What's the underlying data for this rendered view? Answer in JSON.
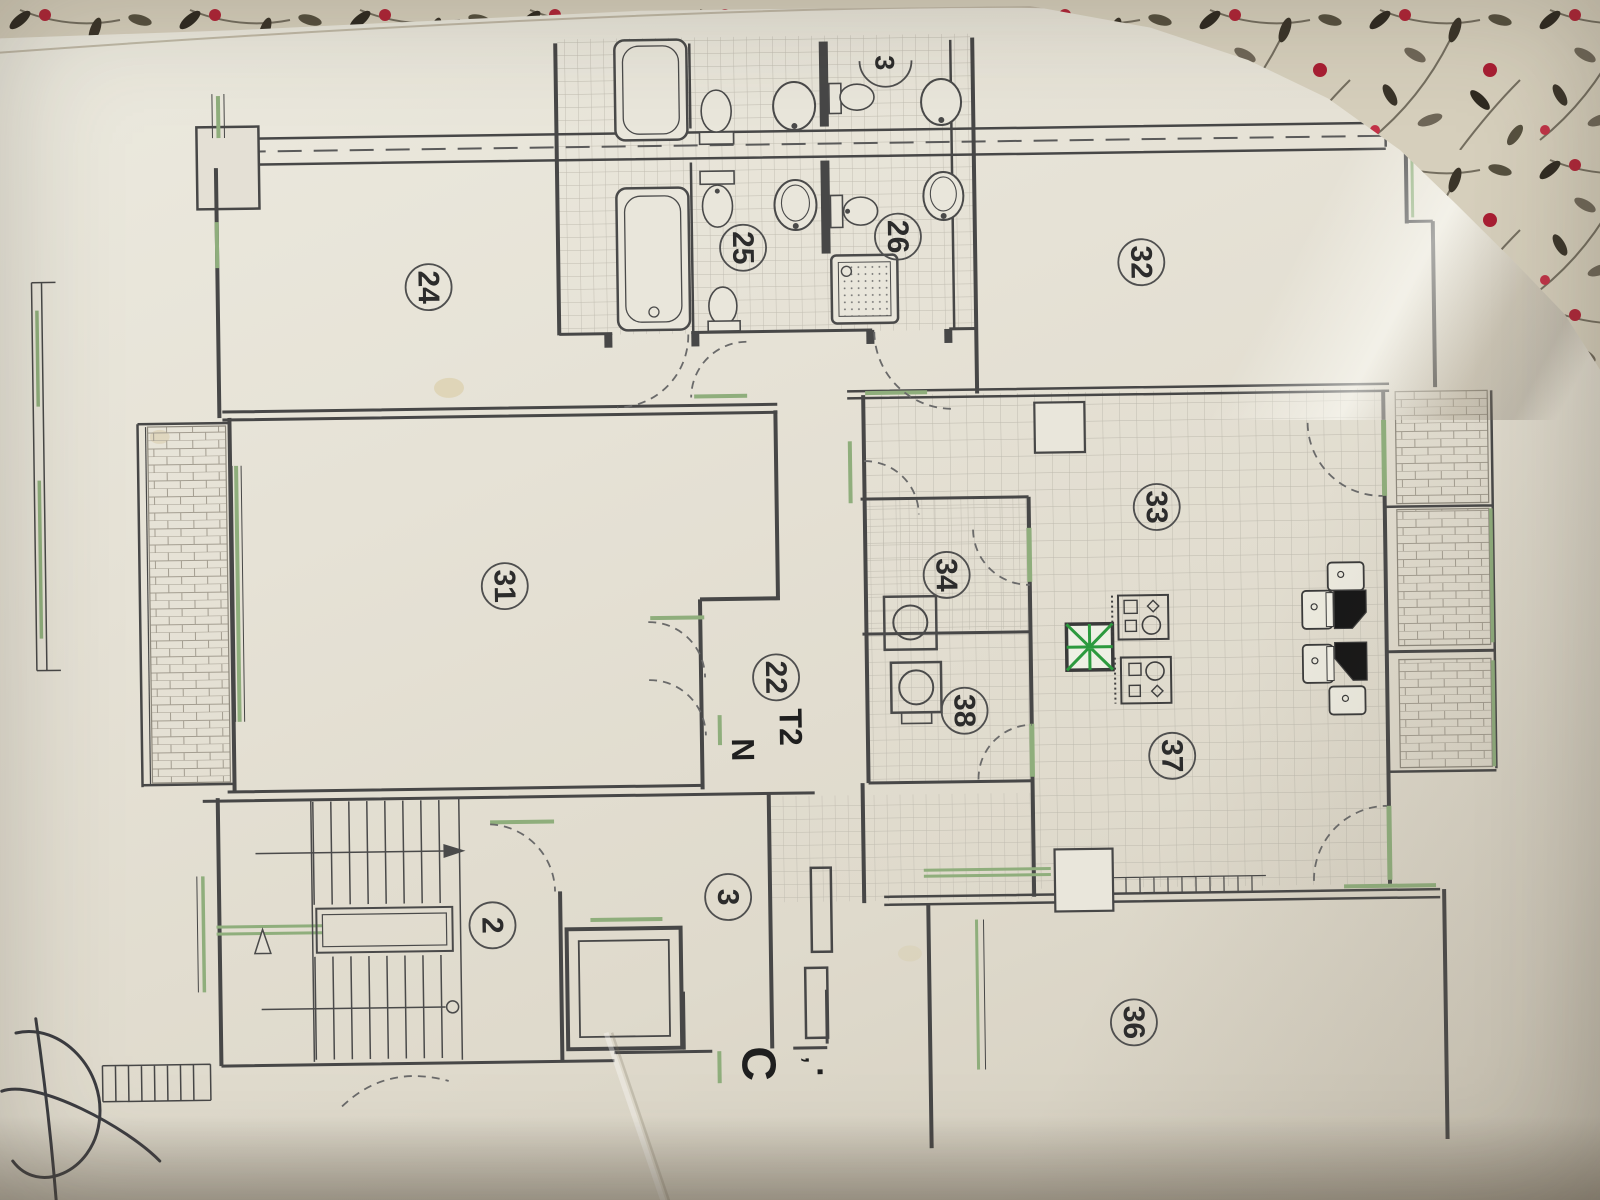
{
  "plan": {
    "partial_room_number": "3",
    "rooms": [
      {
        "number": "24"
      },
      {
        "number": "25"
      },
      {
        "number": "26"
      },
      {
        "number": "32"
      },
      {
        "number": "31"
      },
      {
        "number": "33"
      },
      {
        "number": "34"
      },
      {
        "number": "22"
      },
      {
        "number": "38"
      },
      {
        "number": "37"
      },
      {
        "number": "36"
      },
      {
        "number": "2"
      },
      {
        "number": "3"
      }
    ],
    "labels": {
      "unit_type": "T2",
      "unit_letter": "N",
      "section": "C",
      "tick": "’",
      "dot": "."
    },
    "fixtures": [
      "bathtub",
      "toilet",
      "bidet",
      "washbasin",
      "shower-tray",
      "washing-machine",
      "cooktop",
      "kitchen-sink",
      "ventilation-shaft",
      "staircase",
      "elevator",
      "balcony"
    ],
    "colors": {
      "paper": "#e3dfd4",
      "wall_line": "#474747",
      "window_green": "#8fae7c",
      "shaft_green": "#2c9a3e",
      "tile_line": "#c0bcb0",
      "fabric_base": "#d6cfbc",
      "fabric_leaf_dark": "#332d22",
      "fabric_berry": "#b02437",
      "pen_mark": "#2e2f36"
    }
  }
}
